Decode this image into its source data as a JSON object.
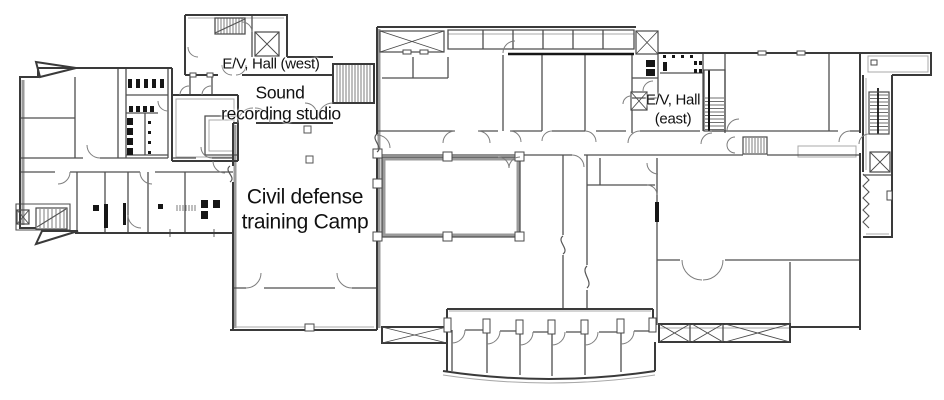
{
  "page": {
    "type": "architectural-floor-plan",
    "background": "#ffffff"
  },
  "colors": {
    "outer_wall": "#3a3a3a",
    "inner_wall": "#4f4f4f",
    "detail_line": "#a8a8a8",
    "fixture": "#161616",
    "text": "#111111"
  },
  "labels": {
    "ev_hall_west": "E/V, Hall (west)",
    "sound_recording_line1": "Sound",
    "sound_recording_line2": "recording studio",
    "civil_defense_line1": "Civil defense",
    "civil_defense_line2": "training Camp",
    "ev_hall_east_line1": "E/V, Hall",
    "ev_hall_east_line2": "(east)"
  }
}
